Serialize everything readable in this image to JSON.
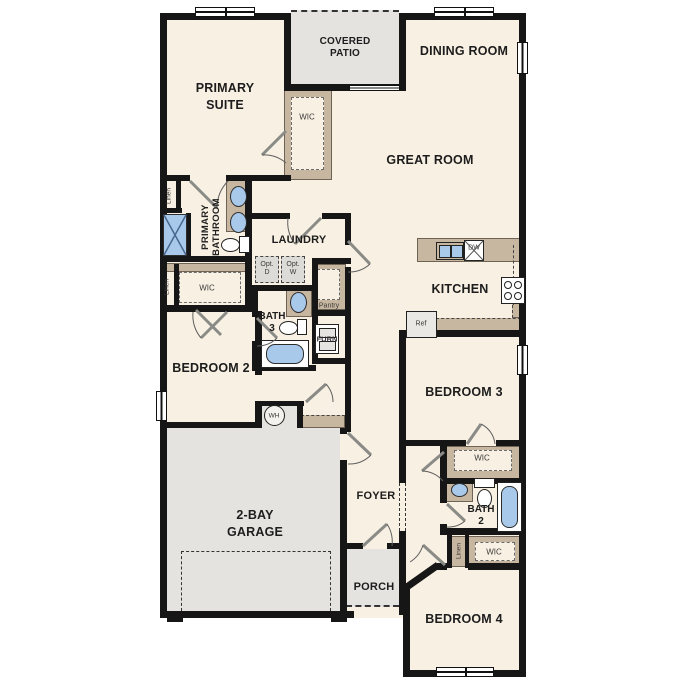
{
  "title": "single-story floor plan",
  "colors": {
    "wall": "#161616",
    "floor": "#f8f0e2",
    "exterior_concrete": "#e4e3e0",
    "cabinetry_tan": "#c8b7a0",
    "fixture_blue": "#a9c9eb"
  },
  "labels": {
    "covered_patio_1": "COVERED",
    "covered_patio_2": "PATIO",
    "dining_room": "DINING ROOM",
    "primary_suite_1": "PRIMARY",
    "primary_suite_2": "SUITE",
    "great_room": "GREAT ROOM",
    "laundry": "LAUNDRY",
    "kitchen": "KITCHEN",
    "primary_bathroom_1": "PRIMARY",
    "primary_bathroom_2": "BATHROOM",
    "wic": "WIC",
    "linen": "Linen",
    "pantry": "Pantry",
    "opt_d_1": "Opt.",
    "opt_d_2": "D",
    "opt_w_1": "Opt.",
    "opt_w_2": "W",
    "bath3_1": "BATH",
    "bath3_2": "3",
    "furn": "FURN",
    "bedroom2": "BEDROOM 2",
    "wh": "WH",
    "garage_1": "2-BAY",
    "garage_2": "GARAGE",
    "foyer": "FOYER",
    "porch": "PORCH",
    "bedroom3": "BEDROOM 3",
    "bath2_1": "BATH",
    "bath2_2": "2",
    "bedroom4": "BEDROOM 4",
    "ref": "Ref",
    "dw": "DW"
  }
}
